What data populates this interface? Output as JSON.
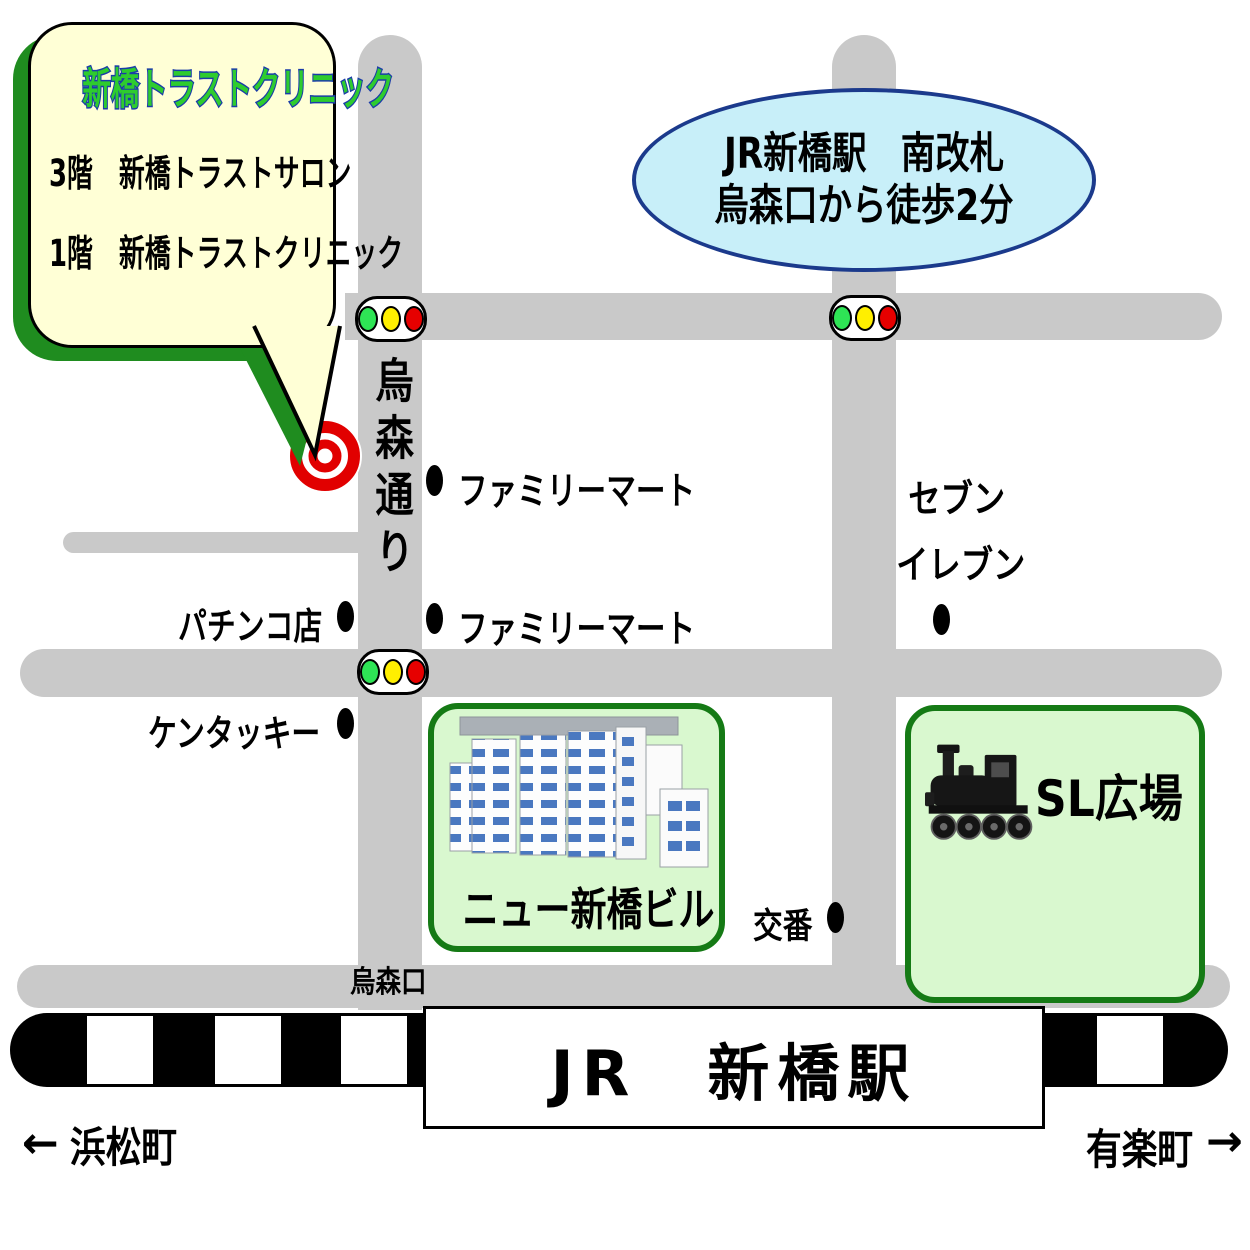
{
  "clinic_bubble": {
    "title": "新橋トラストクリニック",
    "floor3": "3階　新橋トラストサロン",
    "floor1": "1階　新橋トラストクリニック"
  },
  "station_note": {
    "line1": "JR新橋駅　南改札",
    "line2": "烏森口から徒歩2分"
  },
  "street": {
    "name": "烏森通り"
  },
  "landmarks": {
    "familymart1": "ファミリーマート",
    "familymart2": "ファミリーマート",
    "seven_line1": "セブン",
    "seven_line2": "イレブン",
    "pachinko": "パチンコ店",
    "kentucky": "ケンタッキー",
    "koban": "交番",
    "karasumori_exit": "烏森口"
  },
  "buildings": {
    "new_shimbashi_bldg": "ニュー新橋ビル",
    "sl_plaza": "SL広場"
  },
  "station": {
    "label": "JR　新橋駅"
  },
  "nav": {
    "west_arrow": "←",
    "west": "浜松町",
    "east": "有楽町",
    "east_arrow": "→"
  },
  "colors": {
    "road_gray": "#c9c9c9",
    "bubble_fill": "#ffffd6",
    "bubble_shadow_green": "#1f8c1f",
    "clinic_title_green": "#2ecc2e",
    "clinic_title_outline": "#1a3ca8",
    "ellipse_fill": "#c8eff9",
    "ellipse_border": "#1b3a8c",
    "green_box_fill": "#d9f8cf",
    "green_box_border": "#157a15",
    "signal_green": "#2ee455",
    "signal_yellow": "#ffef00",
    "signal_red": "#e60000",
    "target_red": "#e10000",
    "window_blue": "#4a78c0"
  }
}
